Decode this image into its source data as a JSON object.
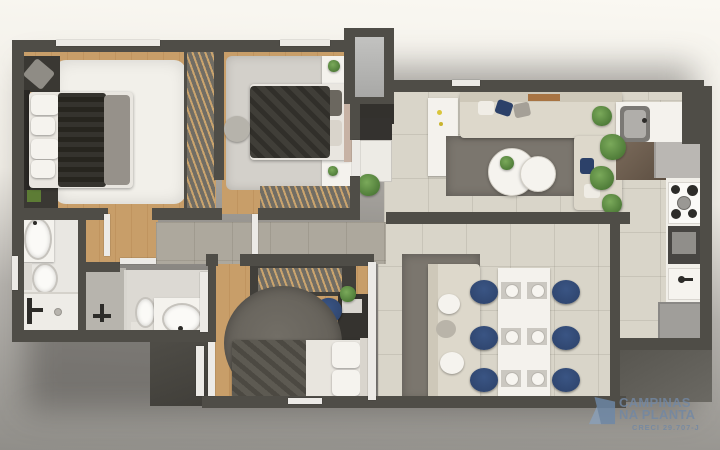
{
  "watermark": {
    "line1": "CAMPINAS",
    "line2": "NA PLANTA",
    "creci": "CRECI 29.707-J"
  },
  "palette": {
    "bg_top": "#faf8f2",
    "bg_mid": "#eeebe4",
    "bg_gray": "#b5b2ad",
    "bg_bottom": "#908e89",
    "wall": "#4f4d47",
    "wood_a": "#c89e69",
    "wood_b": "#c0945f",
    "tile": "#d9d5c9",
    "tile_gray": "#ada89d",
    "bath_floor": "#e9e7e2",
    "rug_white": "#f2f0ea",
    "rug_gray": "#d3d0ca",
    "rug_dark": "#7b766e",
    "rug_round": "#6c6860",
    "sofa": "#ddd8cb",
    "sofa_back": "#cec8b9",
    "navy": "#2c4169",
    "plant": "#557d36",
    "counter": "#f4f2ed",
    "appliance_dark": "#474542",
    "logo_blue": "#6d88a8",
    "logo_blue_light": "#8aa0ba",
    "wm_text": "#7288a4"
  }
}
